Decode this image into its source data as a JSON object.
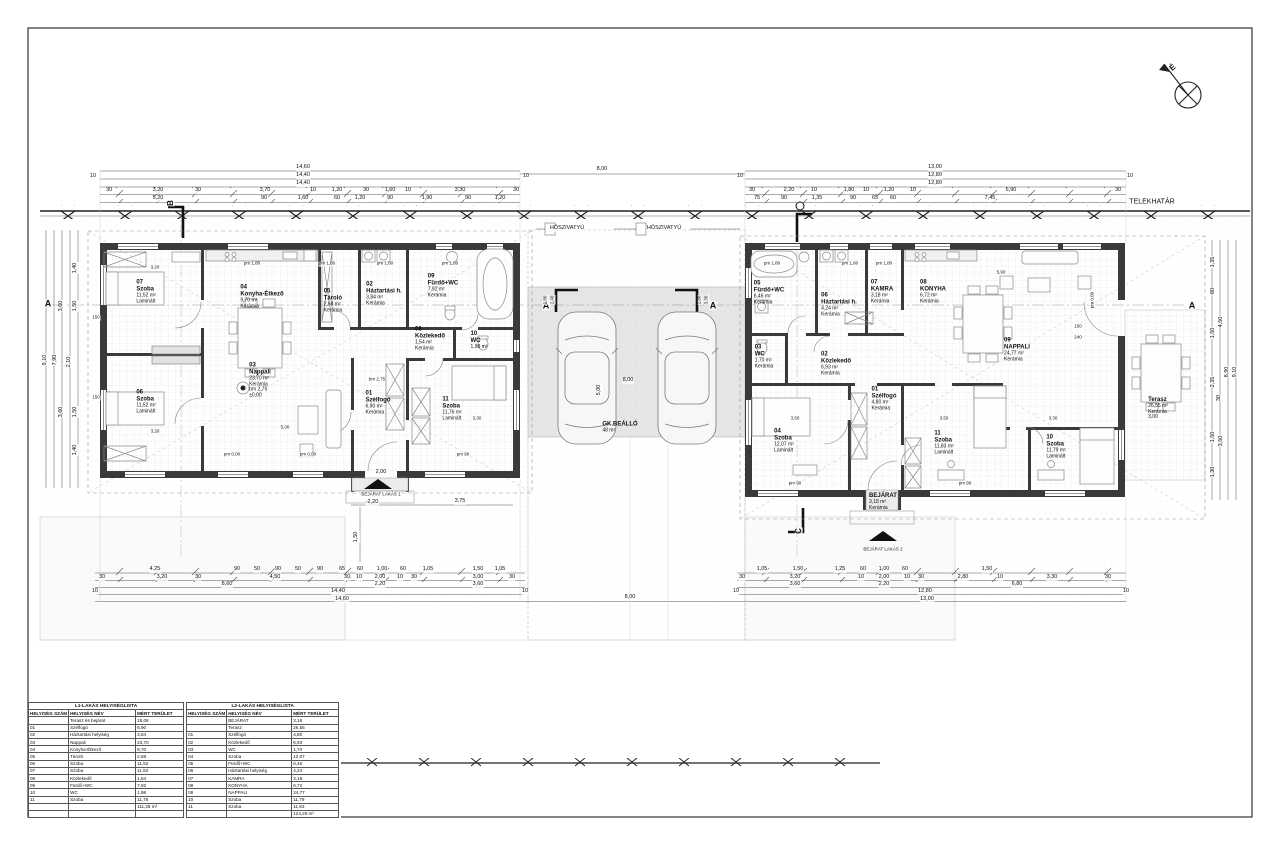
{
  "site": {
    "boundary_label": "TELEKHATÁR",
    "north_label": "É",
    "heat_pump_label": "HŐSZIVATYÚ",
    "parking_name": "GK.BEÁLLÓ",
    "parking_area": "48 m²",
    "entrance1": "BEJÁRAT LAKÁS 1",
    "entrance2": "BEJÁRAT LAKÁS 2",
    "section_markers": [
      "A",
      "B",
      "C"
    ]
  },
  "rooms": [
    {
      "n": "room-b1-07-szoba",
      "x": 146,
      "y": 292,
      "lines": [
        "07",
        "Szoba",
        "11,52 m²",
        "Laminált"
      ]
    },
    {
      "n": "room-b1-04-konyha",
      "x": 262,
      "y": 297,
      "lines": [
        "04",
        "Konyha-Étkező",
        "9,70 m²",
        "Kerámia"
      ]
    },
    {
      "n": "room-b1-05-tarolo",
      "x": 333,
      "y": 301,
      "lines": [
        "05",
        "Tároló",
        "2,68 m²",
        "Kerámia"
      ]
    },
    {
      "n": "room-b1-02-haztartasi",
      "x": 384,
      "y": 294,
      "lines": [
        "02",
        "Háztartási h.",
        "3,84 m²",
        "Kerámia"
      ]
    },
    {
      "n": "room-b1-09-furdo",
      "x": 443,
      "y": 286,
      "lines": [
        "09",
        "Fürdő+WC",
        "7,92 m²",
        "Kerámia"
      ]
    },
    {
      "n": "room-b1-08-kozlekedo",
      "x": 430,
      "y": 339,
      "lines": [
        "08",
        "Közlekedő",
        "1,54 m²",
        "Kerámia"
      ]
    },
    {
      "n": "room-b1-10-wc",
      "x": 479,
      "y": 341,
      "lines": [
        "10",
        "WC",
        "1,98 m²"
      ]
    },
    {
      "n": "room-b1-03-nappali",
      "x": 260,
      "y": 381,
      "lines": [
        "03",
        "Nappali",
        "23,70 m²",
        "Kerámia",
        "bm 2,75",
        "±0,00"
      ]
    },
    {
      "n": "room-b1-06-szoba",
      "x": 146,
      "y": 402,
      "lines": [
        "06",
        "Szoba",
        "11,52 m²",
        "Laminált"
      ]
    },
    {
      "n": "room-b1-01-szelfogo",
      "x": 378,
      "y": 403,
      "lines": [
        "01",
        "Szélfogó",
        "6,90 m²",
        "Kerámia"
      ]
    },
    {
      "n": "room-b1-11-szoba",
      "x": 452,
      "y": 409,
      "lines": [
        "11",
        "Szoba",
        "11,76 m²",
        "Laminált"
      ]
    },
    {
      "n": "room-b2-05-furdo",
      "x": 769,
      "y": 293,
      "lines": [
        "05",
        "Fürdő+WC",
        "6,46 m²",
        "Kerámia"
      ]
    },
    {
      "n": "room-b2-06-haztartasi",
      "x": 839,
      "y": 305,
      "lines": [
        "06",
        "Háztartási h.",
        "4,24 m²",
        "Kerámia"
      ]
    },
    {
      "n": "room-b2-07-kamra",
      "x": 882,
      "y": 292,
      "lines": [
        "07",
        "KAMRA",
        "3,18 m²",
        "Kerámia"
      ]
    },
    {
      "n": "room-b2-08-konyha",
      "x": 933,
      "y": 292,
      "lines": [
        "08",
        "KONYHA",
        "6,72 m²",
        "Kerámia"
      ]
    },
    {
      "n": "room-b2-09-nappali",
      "x": 1017,
      "y": 350,
      "lines": [
        "09",
        "NAPPALI",
        "24,77 m²",
        "Kerámia"
      ]
    },
    {
      "n": "room-b2-03-wc",
      "x": 764,
      "y": 357,
      "lines": [
        "03",
        "WC",
        "1,70 m²",
        "Kerámia"
      ]
    },
    {
      "n": "room-b2-02-kozlekedo",
      "x": 836,
      "y": 364,
      "lines": [
        "02",
        "Közlekedő",
        "6,93 m²",
        "Kerámia"
      ]
    },
    {
      "n": "room-b2-01-szelfogo",
      "x": 884,
      "y": 399,
      "lines": [
        "01",
        "Szélfogó",
        "4,80 m²",
        "Kerámia"
      ]
    },
    {
      "n": "room-b2-04-szoba",
      "x": 784,
      "y": 441,
      "lines": [
        "04",
        "Szoba",
        "12,07 m²",
        "Laminált"
      ]
    },
    {
      "n": "room-b2-11-szoba",
      "x": 944,
      "y": 443,
      "lines": [
        "11",
        "Szoba",
        "11,83 m²",
        "Laminált"
      ]
    },
    {
      "n": "room-b2-10-szoba",
      "x": 1056,
      "y": 447,
      "lines": [
        "10",
        "Szoba",
        "11,79 m²",
        "Laminált"
      ]
    },
    {
      "n": "room-b2-bejarat",
      "x": 883,
      "y": 502,
      "bold": 1,
      "lines": [
        "BEJÁRAT",
        "3,18 m²",
        "Kerámia"
      ]
    },
    {
      "n": "room-b2-terasz",
      "x": 1158,
      "y": 409,
      "bold": 1,
      "lines": [
        "Terasz",
        "26,55 m²",
        "Kerámia",
        "3,00"
      ]
    },
    {
      "n": "parking-label",
      "x": 620,
      "y": 428,
      "bold": 1,
      "lines": [
        "GK.BEÁLLÓ",
        "48 m²"
      ]
    }
  ],
  "labels": [
    {
      "n": "telekhatar-label",
      "t": "TELEKHATÁR",
      "x": 1152,
      "y": 202,
      "f": 7
    },
    {
      "n": "north-label",
      "t": "É",
      "x": 1173,
      "y": 68,
      "f": 8,
      "r": -40,
      "b": 1
    },
    {
      "n": "heat-pump-label",
      "t": "HŐSZIVATYÚ",
      "x": 567,
      "y": 229,
      "f": 5.5
    },
    {
      "n": "heat-pump-label",
      "t": "HŐSZIVATYÚ",
      "x": 664,
      "y": 229,
      "f": 5.5
    },
    {
      "n": "section-marker-a",
      "t": "A",
      "x": 48,
      "y": 304,
      "f": 9,
      "b": 1
    },
    {
      "n": "section-marker-a",
      "t": "A",
      "x": 546,
      "y": 306,
      "f": 9,
      "b": 1
    },
    {
      "n": "section-marker-a",
      "t": "A",
      "x": 713,
      "y": 306,
      "f": 9,
      "b": 1
    },
    {
      "n": "section-marker-a",
      "t": "A",
      "x": 1192,
      "y": 306,
      "f": 9,
      "b": 1
    },
    {
      "n": "section-marker-b",
      "t": "B",
      "x": 171,
      "y": 203,
      "f": 8,
      "b": 1,
      "r": -90
    },
    {
      "n": "section-marker-c",
      "t": "C",
      "x": 799,
      "y": 531,
      "f": 8,
      "b": 1,
      "r": -90
    },
    {
      "n": "entrance-label",
      "t": "BEJÁRAT LAKÁS 1",
      "x": 381,
      "y": 495,
      "f": 4.5
    },
    {
      "n": "entrance-label",
      "t": "BEJÁRAT LAKÁS 2",
      "x": 883,
      "y": 550,
      "f": 4.5
    },
    {
      "t": "14,60",
      "x": 303,
      "y": 168
    },
    {
      "t": "14,40",
      "x": 303,
      "y": 176
    },
    {
      "t": "14,40",
      "x": 303,
      "y": 184
    },
    {
      "t": "10",
      "x": 93,
      "y": 177
    },
    {
      "t": "10",
      "x": 526,
      "y": 177
    },
    {
      "t": "30",
      "x": 109,
      "y": 191
    },
    {
      "t": "3,20",
      "x": 158,
      "y": 191
    },
    {
      "t": "30",
      "x": 198,
      "y": 191
    },
    {
      "t": "3,70",
      "x": 265,
      "y": 191
    },
    {
      "t": "10",
      "x": 313,
      "y": 191
    },
    {
      "t": "1,20",
      "x": 337,
      "y": 191
    },
    {
      "t": "30",
      "x": 366,
      "y": 191
    },
    {
      "t": "1,60",
      "x": 390,
      "y": 191
    },
    {
      "t": "10",
      "x": 408,
      "y": 191
    },
    {
      "t": "3,30",
      "x": 460,
      "y": 191
    },
    {
      "t": "30",
      "x": 516,
      "y": 191
    },
    {
      "t": "5,20",
      "x": 158,
      "y": 199
    },
    {
      "t": "90",
      "x": 264,
      "y": 199
    },
    {
      "t": "1,60",
      "x": 303,
      "y": 199
    },
    {
      "t": "60",
      "x": 337,
      "y": 199
    },
    {
      "t": "1,20",
      "x": 360,
      "y": 199
    },
    {
      "t": "90",
      "x": 390,
      "y": 199
    },
    {
      "t": "1,90",
      "x": 427,
      "y": 199
    },
    {
      "t": "90",
      "x": 468,
      "y": 199
    },
    {
      "t": "1,20",
      "x": 500,
      "y": 199
    },
    {
      "t": "8,00",
      "x": 602,
      "y": 170
    },
    {
      "t": "13,00",
      "x": 935,
      "y": 168
    },
    {
      "t": "12,80",
      "x": 935,
      "y": 176
    },
    {
      "t": "12,80",
      "x": 935,
      "y": 184
    },
    {
      "t": "10",
      "x": 740,
      "y": 177
    },
    {
      "t": "10",
      "x": 1130,
      "y": 177
    },
    {
      "t": "30",
      "x": 752,
      "y": 191
    },
    {
      "t": "2,20",
      "x": 789,
      "y": 191
    },
    {
      "t": "10",
      "x": 814,
      "y": 191
    },
    {
      "t": "1,80",
      "x": 849,
      "y": 191
    },
    {
      "t": "10",
      "x": 866,
      "y": 191
    },
    {
      "t": "1,20",
      "x": 889,
      "y": 191
    },
    {
      "t": "10",
      "x": 913,
      "y": 191
    },
    {
      "t": "6,90",
      "x": 1011,
      "y": 191
    },
    {
      "t": "30",
      "x": 1118,
      "y": 191
    },
    {
      "t": "75",
      "x": 757,
      "y": 199
    },
    {
      "t": "90",
      "x": 784,
      "y": 199
    },
    {
      "t": "1,35",
      "x": 817,
      "y": 199
    },
    {
      "t": "90",
      "x": 853,
      "y": 199
    },
    {
      "t": "65",
      "x": 875,
      "y": 199
    },
    {
      "t": "60",
      "x": 893,
      "y": 199
    },
    {
      "t": "7,45",
      "x": 990,
      "y": 199
    },
    {
      "t": "8,00",
      "x": 628,
      "y": 381
    },
    {
      "t": "5,00",
      "x": 600,
      "y": 390,
      "r": -90
    },
    {
      "t": "2,40",
      "x": 553,
      "y": 300,
      "f": 4.5,
      "r": -90
    },
    {
      "t": "2,80",
      "x": 546,
      "y": 300,
      "f": 4.5,
      "r": -90
    },
    {
      "t": "2,80",
      "x": 700,
      "y": 300,
      "f": 4.5,
      "r": -90
    },
    {
      "t": "3,30",
      "x": 707,
      "y": 300,
      "f": 4.5,
      "r": -90
    },
    {
      "t": "4,25",
      "x": 155,
      "y": 570
    },
    {
      "t": "90",
      "x": 237,
      "y": 570
    },
    {
      "t": "50",
      "x": 257,
      "y": 570
    },
    {
      "t": "90",
      "x": 278,
      "y": 570
    },
    {
      "t": "50",
      "x": 298,
      "y": 570
    },
    {
      "t": "90",
      "x": 320,
      "y": 570
    },
    {
      "t": "65",
      "x": 342,
      "y": 570
    },
    {
      "t": "60",
      "x": 360,
      "y": 570
    },
    {
      "t": "1,00",
      "x": 382,
      "y": 570
    },
    {
      "t": "60",
      "x": 403,
      "y": 570
    },
    {
      "t": "1,05",
      "x": 428,
      "y": 570
    },
    {
      "t": "1,50",
      "x": 478,
      "y": 570
    },
    {
      "t": "1,05",
      "x": 500,
      "y": 570
    },
    {
      "t": "30",
      "x": 102,
      "y": 578
    },
    {
      "t": "3,20",
      "x": 162,
      "y": 578
    },
    {
      "t": "30",
      "x": 198,
      "y": 578
    },
    {
      "t": "4,50",
      "x": 275,
      "y": 578
    },
    {
      "t": "30",
      "x": 347,
      "y": 578
    },
    {
      "t": "10",
      "x": 359,
      "y": 578
    },
    {
      "t": "2,00",
      "x": 380,
      "y": 578
    },
    {
      "t": "10",
      "x": 400,
      "y": 578
    },
    {
      "t": "30",
      "x": 414,
      "y": 578
    },
    {
      "t": "3,00",
      "x": 478,
      "y": 578
    },
    {
      "t": "30",
      "x": 512,
      "y": 578
    },
    {
      "t": "8,60",
      "x": 227,
      "y": 585
    },
    {
      "t": "2,20",
      "x": 380,
      "y": 585
    },
    {
      "t": "3,60",
      "x": 478,
      "y": 585
    },
    {
      "t": "14,40",
      "x": 338,
      "y": 592
    },
    {
      "t": "10",
      "x": 95,
      "y": 592
    },
    {
      "t": "10",
      "x": 525,
      "y": 592
    },
    {
      "t": "14,60",
      "x": 342,
      "y": 600
    },
    {
      "t": "8,00",
      "x": 630,
      "y": 598
    },
    {
      "t": "1,05",
      "x": 762,
      "y": 570
    },
    {
      "t": "1,50",
      "x": 798,
      "y": 570
    },
    {
      "t": "1,25",
      "x": 840,
      "y": 570
    },
    {
      "t": "60",
      "x": 863,
      "y": 570
    },
    {
      "t": "1,00",
      "x": 884,
      "y": 570
    },
    {
      "t": "60",
      "x": 905,
      "y": 570
    },
    {
      "t": "1,50",
      "x": 987,
      "y": 570
    },
    {
      "t": "30",
      "x": 742,
      "y": 578
    },
    {
      "t": "3,20",
      "x": 795,
      "y": 578
    },
    {
      "t": "10",
      "x": 861,
      "y": 578
    },
    {
      "t": "2,00",
      "x": 884,
      "y": 578
    },
    {
      "t": "10",
      "x": 907,
      "y": 578
    },
    {
      "t": "30",
      "x": 921,
      "y": 578
    },
    {
      "t": "2,80",
      "x": 963,
      "y": 578
    },
    {
      "t": "10",
      "x": 1000,
      "y": 578
    },
    {
      "t": "3,30",
      "x": 1052,
      "y": 578
    },
    {
      "t": "30",
      "x": 1108,
      "y": 578
    },
    {
      "t": "3,60",
      "x": 795,
      "y": 585
    },
    {
      "t": "2,20",
      "x": 884,
      "y": 585
    },
    {
      "t": "6,80",
      "x": 1017,
      "y": 585
    },
    {
      "t": "12,80",
      "x": 925,
      "y": 592
    },
    {
      "t": "10",
      "x": 736,
      "y": 592
    },
    {
      "t": "10",
      "x": 1126,
      "y": 592
    },
    {
      "t": "13,00",
      "x": 927,
      "y": 600
    },
    {
      "t": "2,00",
      "x": 381,
      "y": 473
    },
    {
      "t": "-2,20",
      "x": 372,
      "y": 503
    },
    {
      "t": "3,75",
      "x": 460,
      "y": 502
    },
    {
      "t": "1,50",
      "x": 357,
      "y": 537,
      "r": -90
    },
    {
      "t": "9,10",
      "x": 46,
      "y": 360,
      "r": -90
    },
    {
      "t": "7,90",
      "x": 56,
      "y": 360,
      "r": -90
    },
    {
      "t": "1,40",
      "x": 76,
      "y": 268,
      "r": -90
    },
    {
      "t": "3,60",
      "x": 62,
      "y": 306,
      "r": -90
    },
    {
      "t": "1,50",
      "x": 76,
      "y": 306,
      "r": -90
    },
    {
      "t": "2,10",
      "x": 70,
      "y": 362,
      "r": -90
    },
    {
      "t": "3,60",
      "x": 62,
      "y": 412,
      "r": -90
    },
    {
      "t": "1,50",
      "x": 76,
      "y": 412,
      "r": -90
    },
    {
      "t": "1,40",
      "x": 76,
      "y": 450,
      "r": -90
    },
    {
      "t": "9,10",
      "x": 1236,
      "y": 372,
      "r": -90
    },
    {
      "t": "8,90",
      "x": 1228,
      "y": 372,
      "r": -90
    },
    {
      "t": "1,35",
      "x": 1214,
      "y": 262,
      "r": -90
    },
    {
      "t": "80",
      "x": 1214,
      "y": 291,
      "r": -90
    },
    {
      "t": "4,50",
      "x": 1222,
      "y": 322,
      "r": -90
    },
    {
      "t": "1,50",
      "x": 1214,
      "y": 333,
      "r": -90
    },
    {
      "t": "2,35",
      "x": 1214,
      "y": 382,
      "r": -90
    },
    {
      "t": "30",
      "x": 1220,
      "y": 398,
      "r": -90
    },
    {
      "t": "3,50",
      "x": 1222,
      "y": 441,
      "r": -90
    },
    {
      "t": "1,50",
      "x": 1214,
      "y": 437,
      "r": -90
    },
    {
      "t": "1,30",
      "x": 1214,
      "y": 472,
      "r": -90
    },
    {
      "t": "pm 1,80",
      "x": 252,
      "y": 264,
      "f": 4.5
    },
    {
      "t": "pm 1,80",
      "x": 327,
      "y": 264,
      "f": 4.5
    },
    {
      "t": "pm 1,80",
      "x": 385,
      "y": 264,
      "f": 4.5
    },
    {
      "t": "pm 1,80",
      "x": 450,
      "y": 264,
      "f": 4.5
    },
    {
      "t": "pm 1,80",
      "x": 772,
      "y": 264,
      "f": 4.5
    },
    {
      "t": "pm 1,80",
      "x": 850,
      "y": 264,
      "f": 4.5
    },
    {
      "t": "pm 1,80",
      "x": 884,
      "y": 264,
      "f": 4.5
    },
    {
      "t": "pm 0,00",
      "x": 232,
      "y": 455,
      "f": 4.5
    },
    {
      "t": "pm 0,00",
      "x": 308,
      "y": 455,
      "f": 4.5
    },
    {
      "t": "pm 90",
      "x": 463,
      "y": 455,
      "f": 4.5
    },
    {
      "t": "pm 90",
      "x": 795,
      "y": 484,
      "f": 4.5
    },
    {
      "t": "pm 90",
      "x": 965,
      "y": 484,
      "f": 4.5
    },
    {
      "t": "pm 0,00",
      "x": 1093,
      "y": 300,
      "f": 4.5,
      "r": -90
    },
    {
      "t": "bm 2,75",
      "x": 377,
      "y": 380,
      "f": 4.5
    },
    {
      "t": "3,20",
      "x": 155,
      "y": 268,
      "f": 4.5
    },
    {
      "t": "3,20",
      "x": 155,
      "y": 432,
      "f": 4.5
    },
    {
      "t": "5,00",
      "x": 285,
      "y": 428,
      "f": 4.5
    },
    {
      "t": "3,30",
      "x": 477,
      "y": 419,
      "f": 4.5
    },
    {
      "t": "3,50",
      "x": 795,
      "y": 419,
      "f": 4.5
    },
    {
      "t": "3,50",
      "x": 944,
      "y": 419,
      "f": 4.5
    },
    {
      "t": "3,30",
      "x": 1053,
      "y": 419,
      "f": 4.5
    },
    {
      "t": "5,90",
      "x": 1001,
      "y": 273,
      "f": 4.5
    },
    {
      "t": "150",
      "x": 1078,
      "y": 327,
      "f": 4.5
    },
    {
      "t": "240",
      "x": 1078,
      "y": 338,
      "f": 4.5
    },
    {
      "t": "150",
      "x": 96,
      "y": 318,
      "f": 4.5
    },
    {
      "t": "150",
      "x": 96,
      "y": 398,
      "f": 4.5
    }
  ],
  "tables": {
    "t1": {
      "title": "L1-LAKÁS HELYISÉGLISTA",
      "headers": [
        "HELYISÉG SZÁM",
        "HELYISÉG NÉV",
        "MÉRT TERÜLET"
      ],
      "rows": [
        [
          "",
          "Terasz és bejárat",
          "18,08"
        ],
        [
          "01",
          "Szélfogó",
          "6,90"
        ],
        [
          "02",
          "Háztartási helyiség",
          "3,84"
        ],
        [
          "03",
          "Nappali",
          "23,70"
        ],
        [
          "04",
          "Konyha-Étkező",
          "9,70"
        ],
        [
          "05",
          "Tároló",
          "2,68"
        ],
        [
          "06",
          "Szoba",
          "11,52"
        ],
        [
          "07",
          "Szoba",
          "11,52"
        ],
        [
          "08",
          "Közlekedő",
          "1,54"
        ],
        [
          "09",
          "Fürdő+WC",
          "7,92"
        ],
        [
          "10",
          "WC",
          "1,98"
        ],
        [
          "11",
          "Szoba",
          "11,76"
        ]
      ],
      "total": "111,28 m²",
      "trailing_blank": 1
    },
    "t2": {
      "title": "L2-LAKÁS HELYISÉGLISTA",
      "headers": [
        "HELYISÉG SZÁM",
        "HELYISÉG NÉV",
        "MÉRT TERÜLET"
      ],
      "rows": [
        [
          "",
          "BEJÁRAT",
          "3,18"
        ],
        [
          "",
          "Terasz",
          "26,55"
        ],
        [
          "01",
          "Szélfogó",
          "4,80"
        ],
        [
          "02",
          "Közlekedő",
          "6,93"
        ],
        [
          "03",
          "WC",
          "1,70"
        ],
        [
          "04",
          "Szoba",
          "12,07"
        ],
        [
          "05",
          "Fürdő+WC",
          "6,46"
        ],
        [
          "06",
          "Háztartási helyiség",
          "4,24"
        ],
        [
          "07",
          "KAMRA",
          "3,18"
        ],
        [
          "08",
          "KONYHA",
          "6,72"
        ],
        [
          "09",
          "NAPPALI",
          "24,77"
        ],
        [
          "10",
          "Szoba",
          "11,79"
        ],
        [
          "11",
          "Szoba",
          "11,83"
        ]
      ],
      "total": "124,29 m²",
      "trailing_blank": 0
    }
  }
}
